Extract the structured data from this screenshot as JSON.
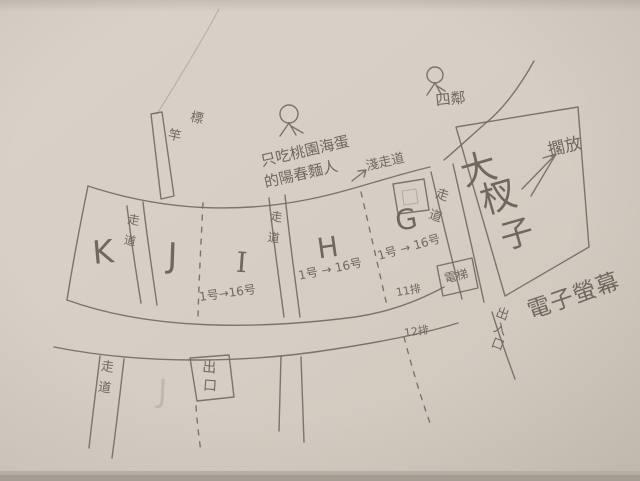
{
  "colors": {
    "paper": "#d5cec4",
    "paper_light": "#dad4ca",
    "paper_dark": "#cec7bb",
    "paper_edge": "#a49d93",
    "pencil": "#6e6861",
    "pencil_light": "#948d84"
  },
  "annotations": [
    {
      "id": "pole-label",
      "text": "標竿",
      "x": 196,
      "y": 122,
      "size": 13,
      "rot": 12,
      "vertical": true,
      "vdx": -18,
      "vdy": 22
    },
    {
      "id": "note-line1",
      "text": "只吃桃園海蛋",
      "x": 306,
      "y": 156,
      "size": 15,
      "rot": -13
    },
    {
      "id": "note-line2",
      "text": "的陽春麵人",
      "x": 302,
      "y": 179,
      "size": 15,
      "rot": -13
    },
    {
      "id": "neighbors-label",
      "text": "四鄰",
      "x": 451,
      "y": 104,
      "size": 15,
      "rot": -6
    },
    {
      "id": "shallow-aisle-label",
      "text": "淺走道",
      "x": 386,
      "y": 166,
      "size": 13,
      "rot": -13
    },
    {
      "id": "put-aside-label",
      "text": "擱放",
      "x": 566,
      "y": 152,
      "size": 17,
      "rot": -13
    },
    {
      "id": "big-box-char-1",
      "text": "大",
      "x": 482,
      "y": 181,
      "size": 36,
      "rot": -16
    },
    {
      "id": "big-box-char-2",
      "text": "杈",
      "x": 502,
      "y": 209,
      "size": 36,
      "rot": -16
    },
    {
      "id": "big-box-char-3",
      "text": "子",
      "x": 520,
      "y": 245,
      "size": 33,
      "rot": -16
    },
    {
      "id": "screen-label",
      "text": "電子螢幕",
      "x": 576,
      "y": 303,
      "size": 23,
      "rot": -19,
      "spacing": 1
    },
    {
      "id": "elevator-label",
      "text": "電梯",
      "x": 457,
      "y": 280,
      "size": 12,
      "rot": -12
    },
    {
      "id": "entrance-exit-label",
      "text": "出入口",
      "x": 501,
      "y": 318,
      "size": 13,
      "rot": 20,
      "vertical": true,
      "vdx": 3,
      "vdy": 15
    },
    {
      "id": "exit-label",
      "text": "出口",
      "x": 209,
      "y": 372,
      "size": 14,
      "rot": 4,
      "vertical": true,
      "vdx": 2,
      "vdy": 18
    },
    {
      "id": "row-11-label",
      "text": "11排",
      "x": 409,
      "y": 294,
      "size": 11,
      "rot": -10
    },
    {
      "id": "row-12-label",
      "text": "12排",
      "x": 417,
      "y": 335,
      "size": 11,
      "rot": -8
    },
    {
      "id": "aisle-kj-label",
      "text": "走道",
      "x": 133,
      "y": 224,
      "size": 12,
      "rot": 10,
      "vertical": true,
      "vdy": 21
    },
    {
      "id": "aisle-ih-label",
      "text": "走道",
      "x": 276,
      "y": 221,
      "size": 12,
      "rot": 8,
      "vertical": true,
      "vdy": 21
    },
    {
      "id": "aisle-g-label",
      "text": "走道",
      "x": 441,
      "y": 199,
      "size": 13,
      "rot": 18,
      "vertical": true,
      "vdy": 22
    },
    {
      "id": "aisle-lower-label",
      "text": "走道",
      "x": 107,
      "y": 371,
      "size": 13,
      "rot": 8,
      "vertical": true,
      "vdy": 21
    },
    {
      "id": "section-k",
      "text": "K",
      "x": 104,
      "y": 263,
      "size": 32,
      "rot": -5
    },
    {
      "id": "section-j",
      "text": "J",
      "x": 172,
      "y": 267,
      "size": 34,
      "rot": 2
    },
    {
      "id": "section-i",
      "text": "I",
      "x": 241,
      "y": 272,
      "size": 28,
      "rot": 4,
      "serif": true
    },
    {
      "id": "section-h",
      "text": "H",
      "x": 329,
      "y": 257,
      "size": 28,
      "rot": -8
    },
    {
      "id": "section-g",
      "text": "G",
      "x": 408,
      "y": 229,
      "size": 28,
      "rot": -10
    },
    {
      "id": "section-j-ghost",
      "text": "J",
      "x": 162,
      "y": 402,
      "size": 32,
      "rot": 3,
      "opacity": 0.2
    },
    {
      "id": "range-i",
      "text": "1号→16号",
      "x": 228,
      "y": 297,
      "size": 12,
      "rot": -8
    },
    {
      "id": "range-h",
      "text": "1号 → 16号",
      "x": 331,
      "y": 273,
      "size": 12,
      "rot": -12
    },
    {
      "id": "range-g",
      "text": "1号 → 16号",
      "x": 410,
      "y": 251,
      "size": 12,
      "rot": -16
    }
  ]
}
